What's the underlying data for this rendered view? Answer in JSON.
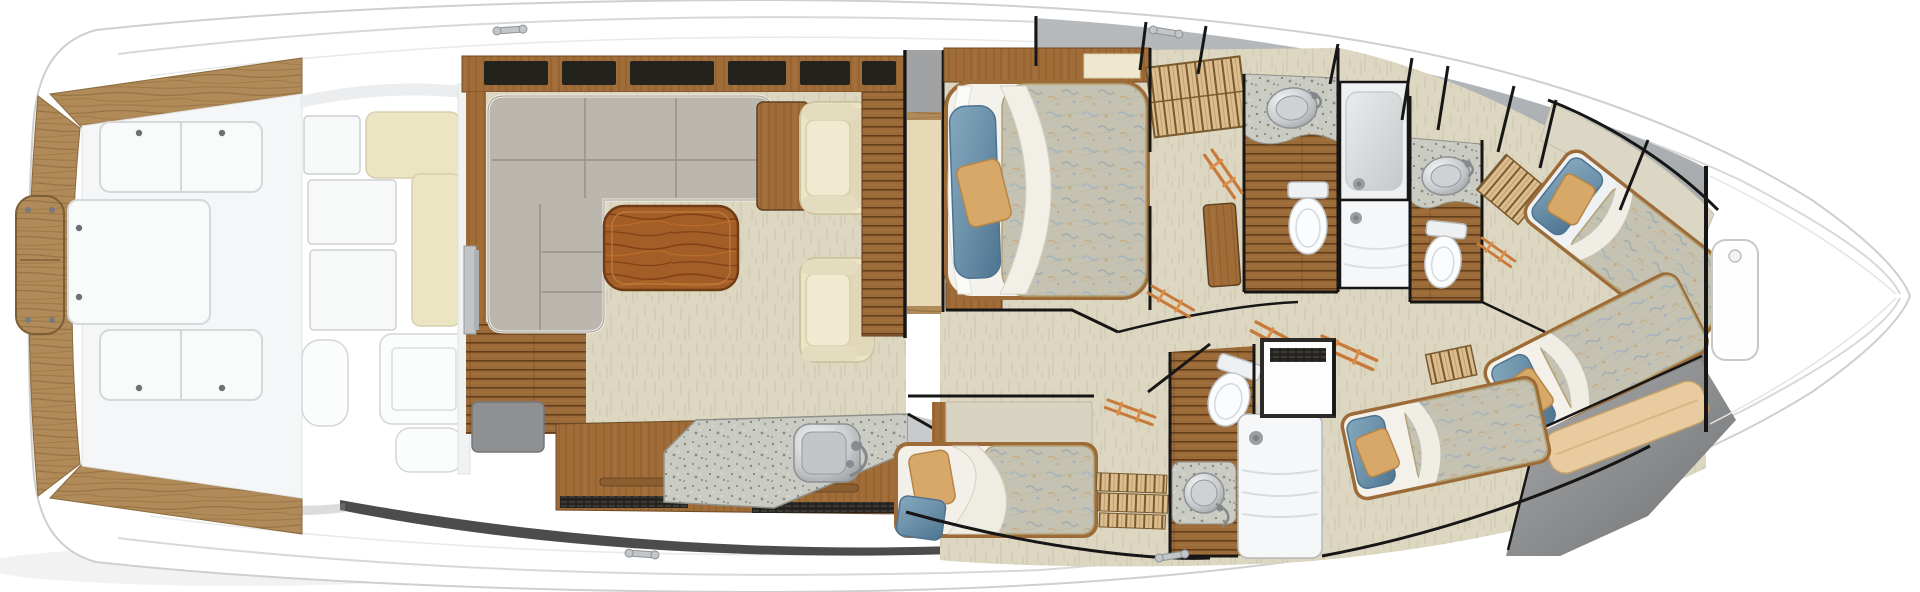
{
  "palette": {
    "hull-white": "#ffffff",
    "hull-line": "#cfcfcf",
    "sheer-line": "#d8d8d8",
    "teak": "#b08a58",
    "teak-dark": "#8f6b3c",
    "plank": "#9a6a38",
    "plank-dark": "#5d3716",
    "cabinet-wood": "#a06c38",
    "rich-wood": "#a35d26",
    "carpet": "#ddd7c1",
    "carpet-line": "#cfc9b2",
    "speckle": "#caccc4",
    "sofa": "#bcb7ae",
    "sofa-seam": "#918c82",
    "cream": "#ece5c3",
    "cream-wall": "#e8d9b6",
    "wall-gray": "#a9adb0",
    "wall-dark": "#161616",
    "pillow-blue": "#6e93ab",
    "pillow-blue-dark": "#4e7390",
    "pillow-tan": "#d8a868",
    "comforter": "#c5c2b2",
    "shower-white": "#f6f7f8",
    "sole-gray": "#9a9b9d",
    "rail-orange": "#c87a3a",
    "mat-gray": "#8e9092",
    "deck-sole": "#f4f6f7"
  },
  "fixture_icons": [
    "cleat-icon",
    "deck-hatch-icon",
    "screw-icon",
    "sofa-icon",
    "coffee-table-icon",
    "armchair-icon",
    "galley-sink-icon",
    "galley-counter-icon",
    "double-berth-icon",
    "single-berth-icon",
    "blue-pillow-icon",
    "tan-pillow-icon",
    "toilet-icon",
    "vanity-sink-icon",
    "shower-stall-icon",
    "shower-drain-icon",
    "companionway-steps-icon",
    "ladder-rail-icon",
    "louvered-locker-icon",
    "bench-icon",
    "bow-hatch-icon",
    "sliding-door-icon"
  ],
  "fixture_counts": {
    "berths": 5,
    "toilets": 3,
    "vanity-sinks": 3,
    "galley-sinks": 1,
    "shower-stalls": 3,
    "deck-hatches": 4,
    "cleats": 4,
    "armchairs": 2
  }
}
